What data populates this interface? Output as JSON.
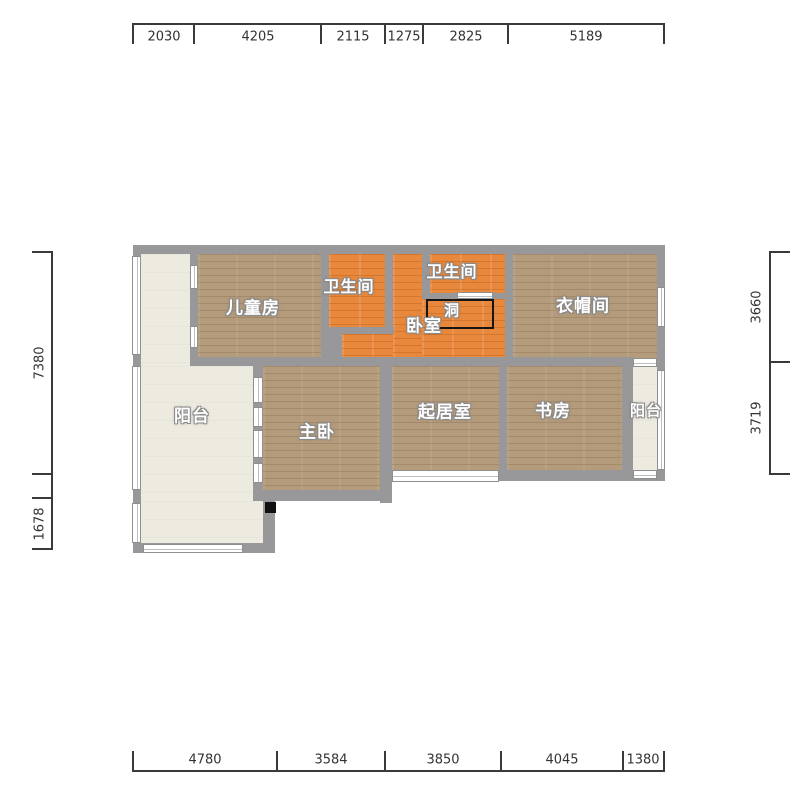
{
  "dims": {
    "top": [
      "2030",
      "4205",
      "2115",
      "1275",
      "2825",
      "5189"
    ],
    "bottom": [
      "4780",
      "3584",
      "3850",
      "4045",
      "1380"
    ],
    "left": [
      "7380",
      "1678"
    ],
    "right": [
      "3660",
      "3719"
    ]
  },
  "rooms": {
    "children": "儿童房",
    "bath1": "卫生间",
    "bath2": "卫生间",
    "bedroom": "卧室",
    "hole": "洞",
    "cloakroom": "衣帽间",
    "balcony_left": "阳台",
    "master": "主卧",
    "living": "起居室",
    "study": "书房",
    "balcony_right": "阳台"
  },
  "colors": {
    "wall": "#98989a",
    "wood_floor": "#b49b7c",
    "orange_floor": "#e8883c",
    "balcony_floor": "#edeae0",
    "hole_outline": "#151515",
    "dimension_text": "#333333",
    "label_text": "#ffffff"
  }
}
